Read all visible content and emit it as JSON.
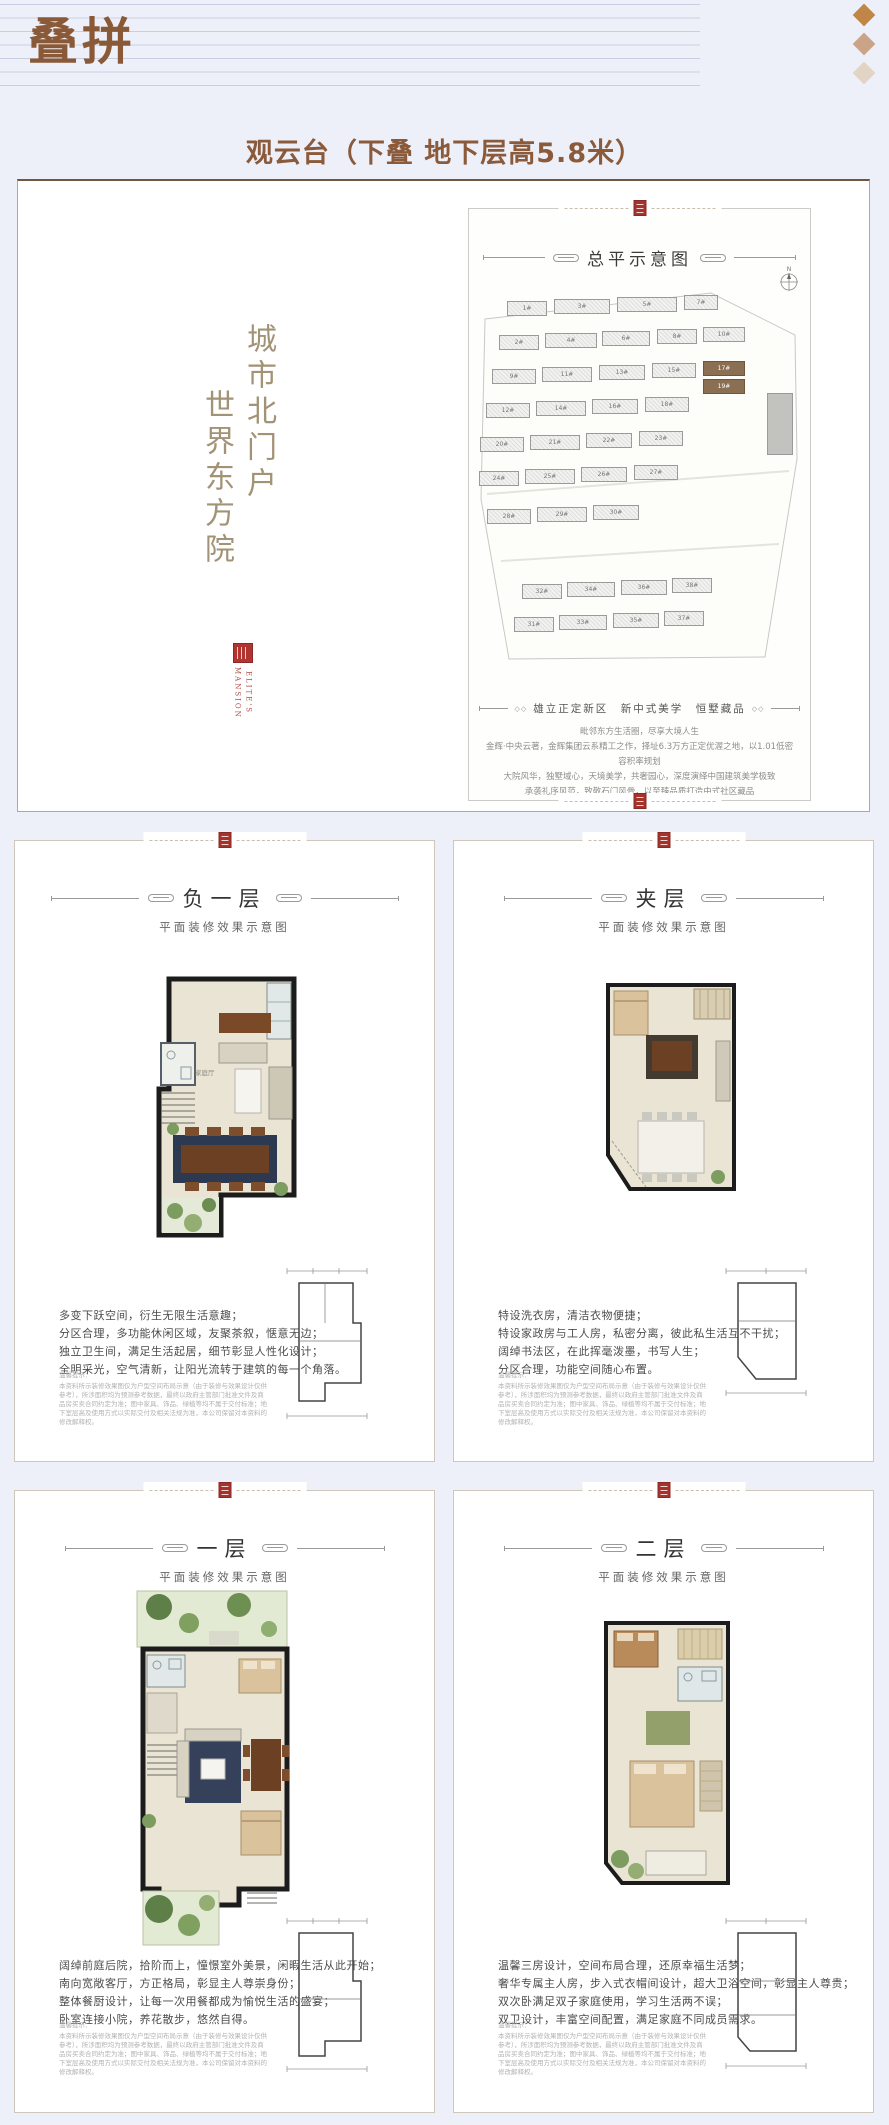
{
  "page": {
    "title": "叠拼",
    "subtitle": "观云台（下叠 地下层高5.8米）"
  },
  "hero": {
    "vertical_slogan_right": "城市北门户",
    "vertical_slogan_left": "世界东方院",
    "logo": {
      "word_left": "MANSION",
      "word_right": "ELITE'S"
    },
    "panel": {
      "title": "总平示意图",
      "compass_label": "N",
      "tagline": "雄立正定新区　新中式美学　恒墅藏品",
      "paragraph": [
        "毗邻东方生活圈，尽享大境人生",
        "金辉·中央云著，金辉集团云系精工之作，择址6.3万方正定优渥之地，以1.01低密容积率规划",
        "大院风华，独墅域心，天境美学，共奢园心，深度演绎中国建筑美学极致",
        "承袭礼序风范，致敬石门风骨，以至臻品质打造中式社区藏品"
      ],
      "buildings": [
        {
          "label": "1#",
          "x": 28,
          "y": 12,
          "w": 40,
          "h": 15
        },
        {
          "label": "3#",
          "x": 75,
          "y": 10,
          "w": 56,
          "h": 15
        },
        {
          "label": "5#",
          "x": 138,
          "y": 8,
          "w": 60,
          "h": 15
        },
        {
          "label": "7#",
          "x": 205,
          "y": 6,
          "w": 34,
          "h": 15
        },
        {
          "label": "2#",
          "x": 20,
          "y": 46,
          "w": 40,
          "h": 15
        },
        {
          "label": "4#",
          "x": 66,
          "y": 44,
          "w": 52,
          "h": 15
        },
        {
          "label": "6#",
          "x": 123,
          "y": 42,
          "w": 48,
          "h": 15
        },
        {
          "label": "8#",
          "x": 178,
          "y": 40,
          "w": 40,
          "h": 15
        },
        {
          "label": "10#",
          "x": 224,
          "y": 38,
          "w": 42,
          "h": 15
        },
        {
          "label": "9#",
          "x": 13,
          "y": 80,
          "w": 44,
          "h": 15
        },
        {
          "label": "11#",
          "x": 63,
          "y": 78,
          "w": 50,
          "h": 15
        },
        {
          "label": "13#",
          "x": 120,
          "y": 76,
          "w": 46,
          "h": 15
        },
        {
          "label": "15#",
          "x": 173,
          "y": 74,
          "w": 44,
          "h": 15
        },
        {
          "label": "17#",
          "x": 224,
          "y": 72,
          "w": 42,
          "h": 15,
          "hl": true
        },
        {
          "label": "12#",
          "x": 7,
          "y": 114,
          "w": 44,
          "h": 15
        },
        {
          "label": "14#",
          "x": 57,
          "y": 112,
          "w": 50,
          "h": 15
        },
        {
          "label": "16#",
          "x": 113,
          "y": 110,
          "w": 46,
          "h": 15
        },
        {
          "label": "18#",
          "x": 166,
          "y": 108,
          "w": 44,
          "h": 15
        },
        {
          "label": "19#",
          "x": 224,
          "y": 90,
          "w": 42,
          "h": 15,
          "hl": true
        },
        {
          "label": "",
          "x": 288,
          "y": 104,
          "w": 26,
          "h": 62,
          "tall": true
        },
        {
          "label": "20#",
          "x": 1,
          "y": 148,
          "w": 44,
          "h": 15
        },
        {
          "label": "21#",
          "x": 51,
          "y": 146,
          "w": 50,
          "h": 15
        },
        {
          "label": "22#",
          "x": 107,
          "y": 144,
          "w": 46,
          "h": 15
        },
        {
          "label": "23#",
          "x": 160,
          "y": 142,
          "w": 44,
          "h": 15
        },
        {
          "label": "24#",
          "x": 0,
          "y": 182,
          "w": 40,
          "h": 15
        },
        {
          "label": "25#",
          "x": 46,
          "y": 180,
          "w": 50,
          "h": 15
        },
        {
          "label": "26#",
          "x": 102,
          "y": 178,
          "w": 46,
          "h": 15
        },
        {
          "label": "27#",
          "x": 155,
          "y": 176,
          "w": 44,
          "h": 15
        },
        {
          "label": "28#",
          "x": 8,
          "y": 220,
          "w": 44,
          "h": 15
        },
        {
          "label": "29#",
          "x": 58,
          "y": 218,
          "w": 50,
          "h": 15
        },
        {
          "label": "30#",
          "x": 114,
          "y": 216,
          "w": 46,
          "h": 15
        },
        {
          "label": "32#",
          "x": 43,
          "y": 295,
          "w": 40,
          "h": 15
        },
        {
          "label": "34#",
          "x": 88,
          "y": 293,
          "w": 48,
          "h": 15
        },
        {
          "label": "36#",
          "x": 142,
          "y": 291,
          "w": 46,
          "h": 15
        },
        {
          "label": "38#",
          "x": 193,
          "y": 289,
          "w": 40,
          "h": 15
        },
        {
          "label": "31#",
          "x": 35,
          "y": 328,
          "w": 40,
          "h": 15
        },
        {
          "label": "33#",
          "x": 80,
          "y": 326,
          "w": 48,
          "h": 15
        },
        {
          "label": "35#",
          "x": 134,
          "y": 324,
          "w": 46,
          "h": 15
        },
        {
          "label": "37#",
          "x": 185,
          "y": 322,
          "w": 40,
          "h": 15
        }
      ]
    }
  },
  "floor_common": {
    "subtitle": "平面装修效果示意图",
    "tips_title": "温馨提示：",
    "tips": "本资料所示装修效果图仅为户型空间布局示意（由于装修与效果设计仅供参考），所涉面积均为预测参考数据，最终以政府主管部门批准文件及商品房买卖合同约定为准；图中家具、饰品、绿植等均不属于交付标准；地下室层高及使用方式以实际交付及相关法规为准，本公司保留对本资料的修改解释权。"
  },
  "floor_cards": [
    {
      "title": "负一层",
      "room_label": "家庭厅",
      "description": [
        "多变下跃空间，衍生无限生活意趣；",
        "分区合理，多功能休闲区域，友聚茶叙，惬意无边；",
        "独立卫生间，满足生活起居，细节彰显人性化设计；",
        "全明采光，空气清新，让阳光流转于建筑的每一个角落。"
      ]
    },
    {
      "title": "夹层",
      "description": [
        "特设洗衣房，清洁衣物便捷；",
        "特设家政房与工人房，私密分离，彼此私生活互不干扰；",
        "阔绰书法区，在此挥毫泼墨，书写人生；",
        "分区合理，功能空间随心布置。"
      ]
    },
    {
      "title": "一层",
      "description": [
        "阔绰前庭后院，拾阶而上，憧憬室外美景，闲暇生活从此开始；",
        "南向宽敞客厅，方正格局，彰显主人尊崇身份；",
        "整体餐厨设计，让每一次用餐都成为愉悦生活的盛宴；",
        "卧室连接小院，养花散步，悠然自得。"
      ]
    },
    {
      "title": "二层",
      "description": [
        "温馨三房设计，空间布局合理，还原幸福生活梦；",
        "奢华专属主人房，步入式衣帽间设计，超大卫浴空间，彰显主人尊贵；",
        "双次卧满足双子家庭使用，学习生活两不误；",
        "双卫设计，丰富空间配置，满足家庭不同成员需求。"
      ]
    }
  ]
}
